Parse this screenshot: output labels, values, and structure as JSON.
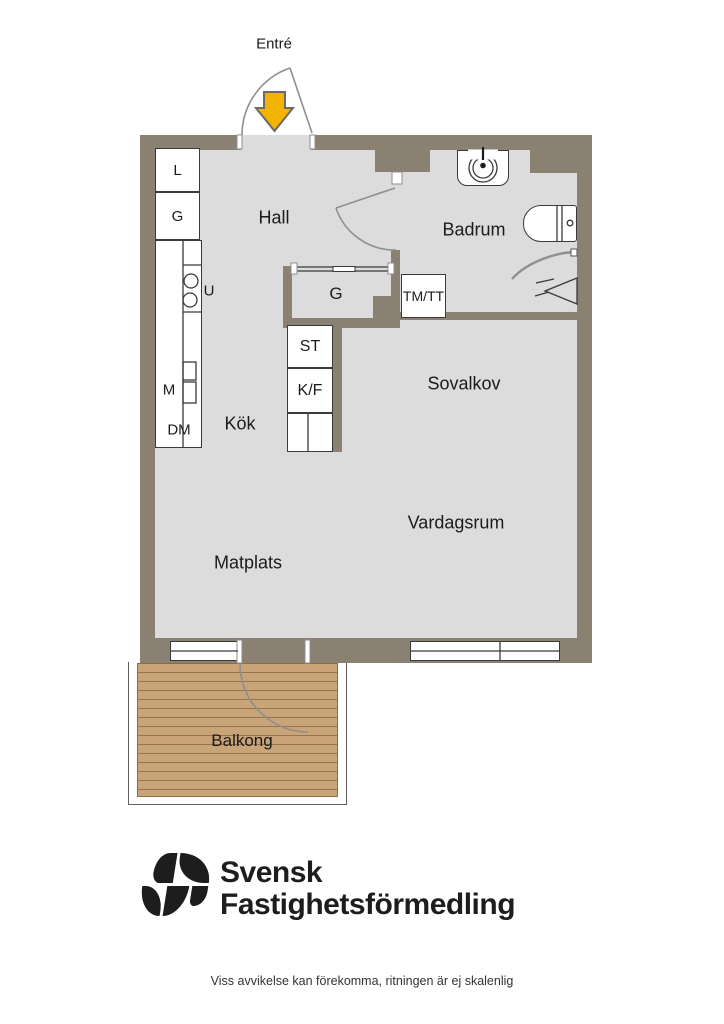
{
  "plan": {
    "rooms": {
      "entre": "Entré",
      "hall": "Hall",
      "badrum": "Badrum",
      "kok": "Kök",
      "matplats": "Matplats",
      "sovalkov": "Sovalkov",
      "vardagsrum": "Vardagsrum",
      "balkong": "Balkong"
    },
    "fixtures": {
      "closet_linen": "L",
      "closet_wardrobe": "G",
      "hall_wardrobe": "G",
      "washer_dryer": "TM/TT",
      "cleaning_closet": "ST",
      "fridge_freezer": "K/F",
      "oven": "U",
      "microwave": "M",
      "dishwasher": "DM"
    }
  },
  "colors": {
    "wall": "#8a8172",
    "floor": "#dcdcdc",
    "deck": "#c8a478",
    "arrow": "#f2b400",
    "line": "#3a3a3a"
  },
  "brand": {
    "name_line1": "Svensk",
    "name_line2": "Fastighetsförmedling"
  },
  "footer": {
    "disclaimer": "Viss avvikelse kan förekomma, ritningen är ej skalenlig"
  }
}
